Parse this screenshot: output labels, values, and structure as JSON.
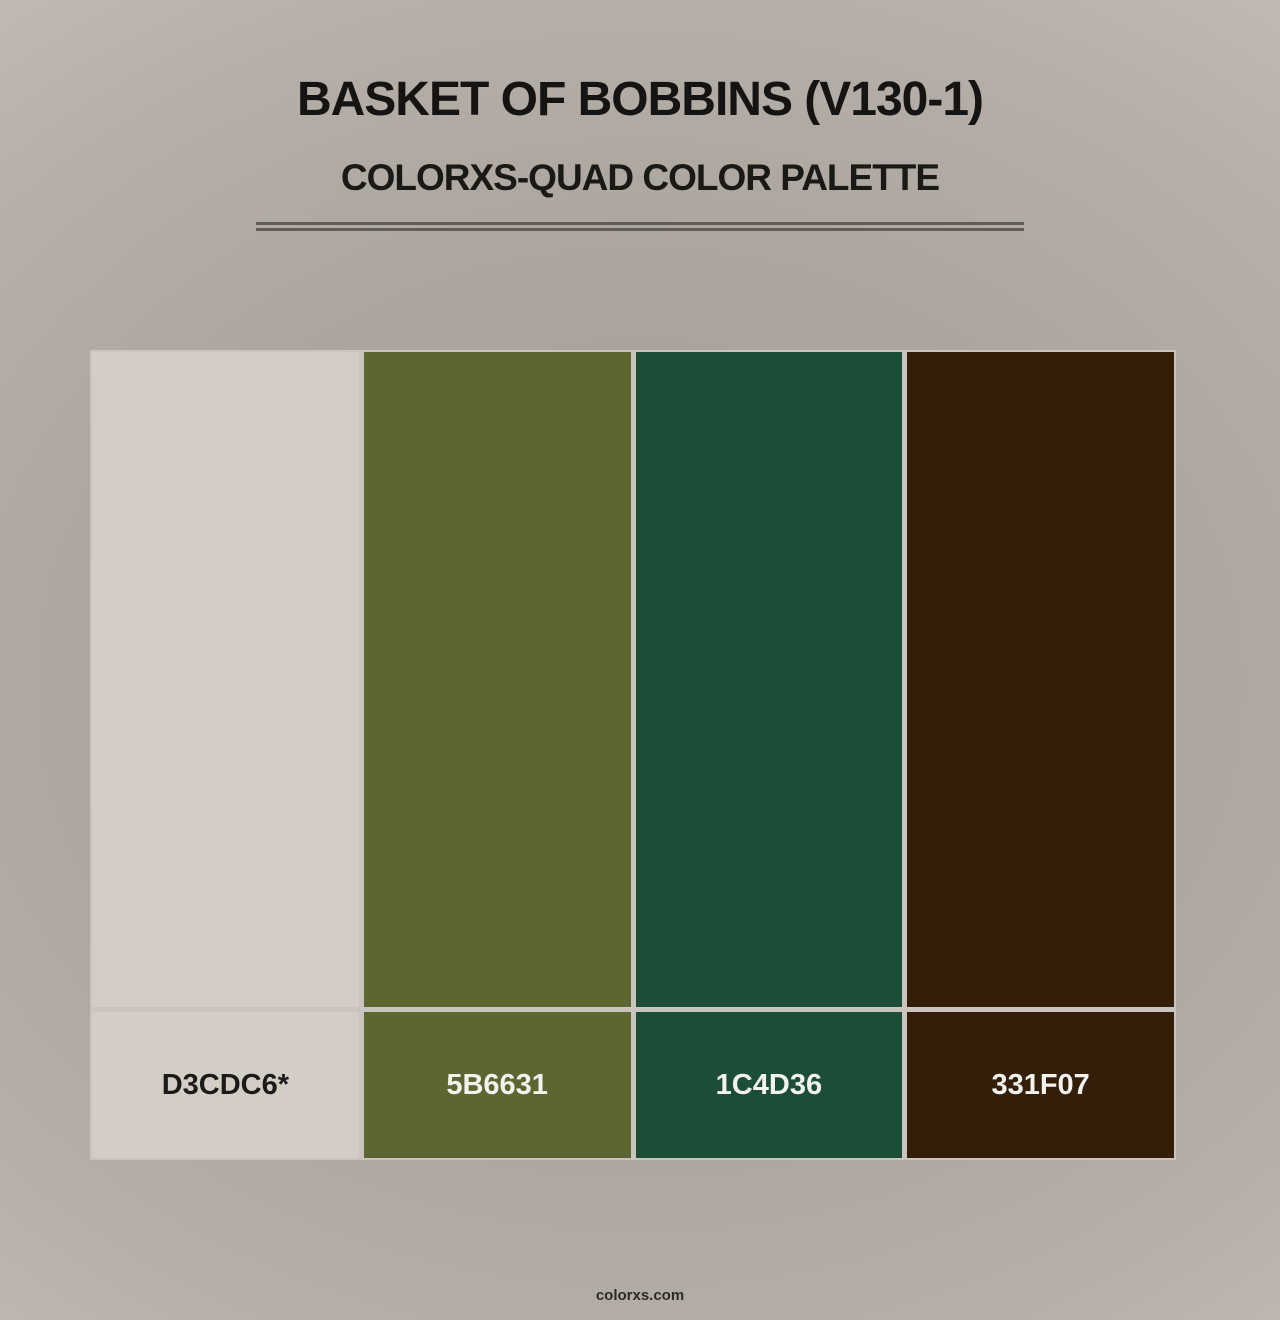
{
  "page": {
    "title": "BASKET OF BOBBINS (V130-1)",
    "subtitle": "COLORXS-QUAD COLOR PALETTE",
    "footer": "colorxs.com"
  },
  "palette": {
    "name": "Basket of Bobbins (V130-1)",
    "type": "quad",
    "swatches": [
      {
        "label": "D3CDC6*",
        "hex": "#D3CDC6",
        "text_color": "#1b1a18"
      },
      {
        "label": "5B6631",
        "hex": "#5B6631",
        "text_color": "#f4f2ee"
      },
      {
        "label": "1C4D36",
        "hex": "#1C4D36",
        "text_color": "#f4f2ee"
      },
      {
        "label": "331F07",
        "hex": "#331F07",
        "text_color": "#f4f2ee"
      }
    ]
  },
  "colors": {
    "background_center": "#a6a099",
    "background_edge": "#c8c1bb",
    "divider": "#615c55",
    "grid_gap": "#c9c4bd",
    "title_text": "#161412"
  }
}
